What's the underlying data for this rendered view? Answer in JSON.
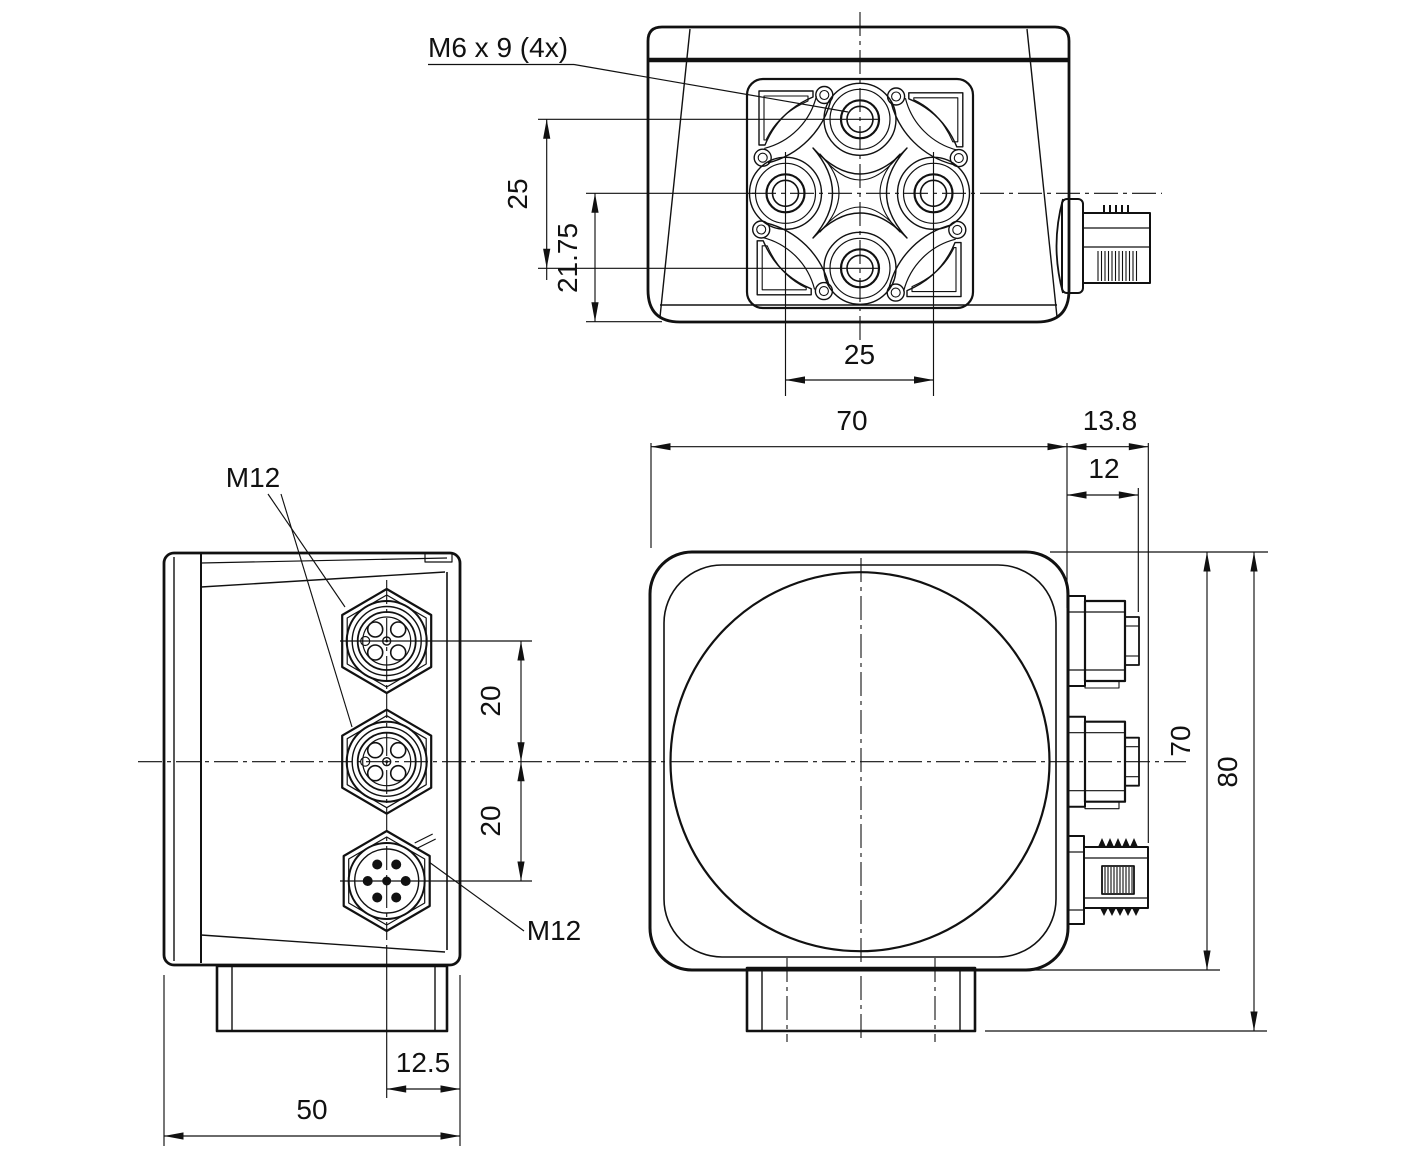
{
  "drawing": {
    "labels": {
      "mounting_thread_note": "M6 x 9 (4x)",
      "m12_top": "M12",
      "m12_bottom": "M12"
    },
    "dims": {
      "top_view": {
        "hole_spacing_vertical": "25",
        "center_to_front_edge": "21.75",
        "hole_spacing_horizontal": "25"
      },
      "side_view": {
        "connector_pitch_upper": "20",
        "connector_pitch_lower": "20",
        "connector_axis_to_rear": "12.5",
        "housing_depth": "50"
      },
      "front_view": {
        "housing_width": "70",
        "connector_protrusion_max": "13.8",
        "connector_protrusion": "12",
        "housing_height": "70",
        "overall_height": "80"
      }
    },
    "colors": {
      "line": "#111111",
      "background": "#ffffff"
    }
  }
}
